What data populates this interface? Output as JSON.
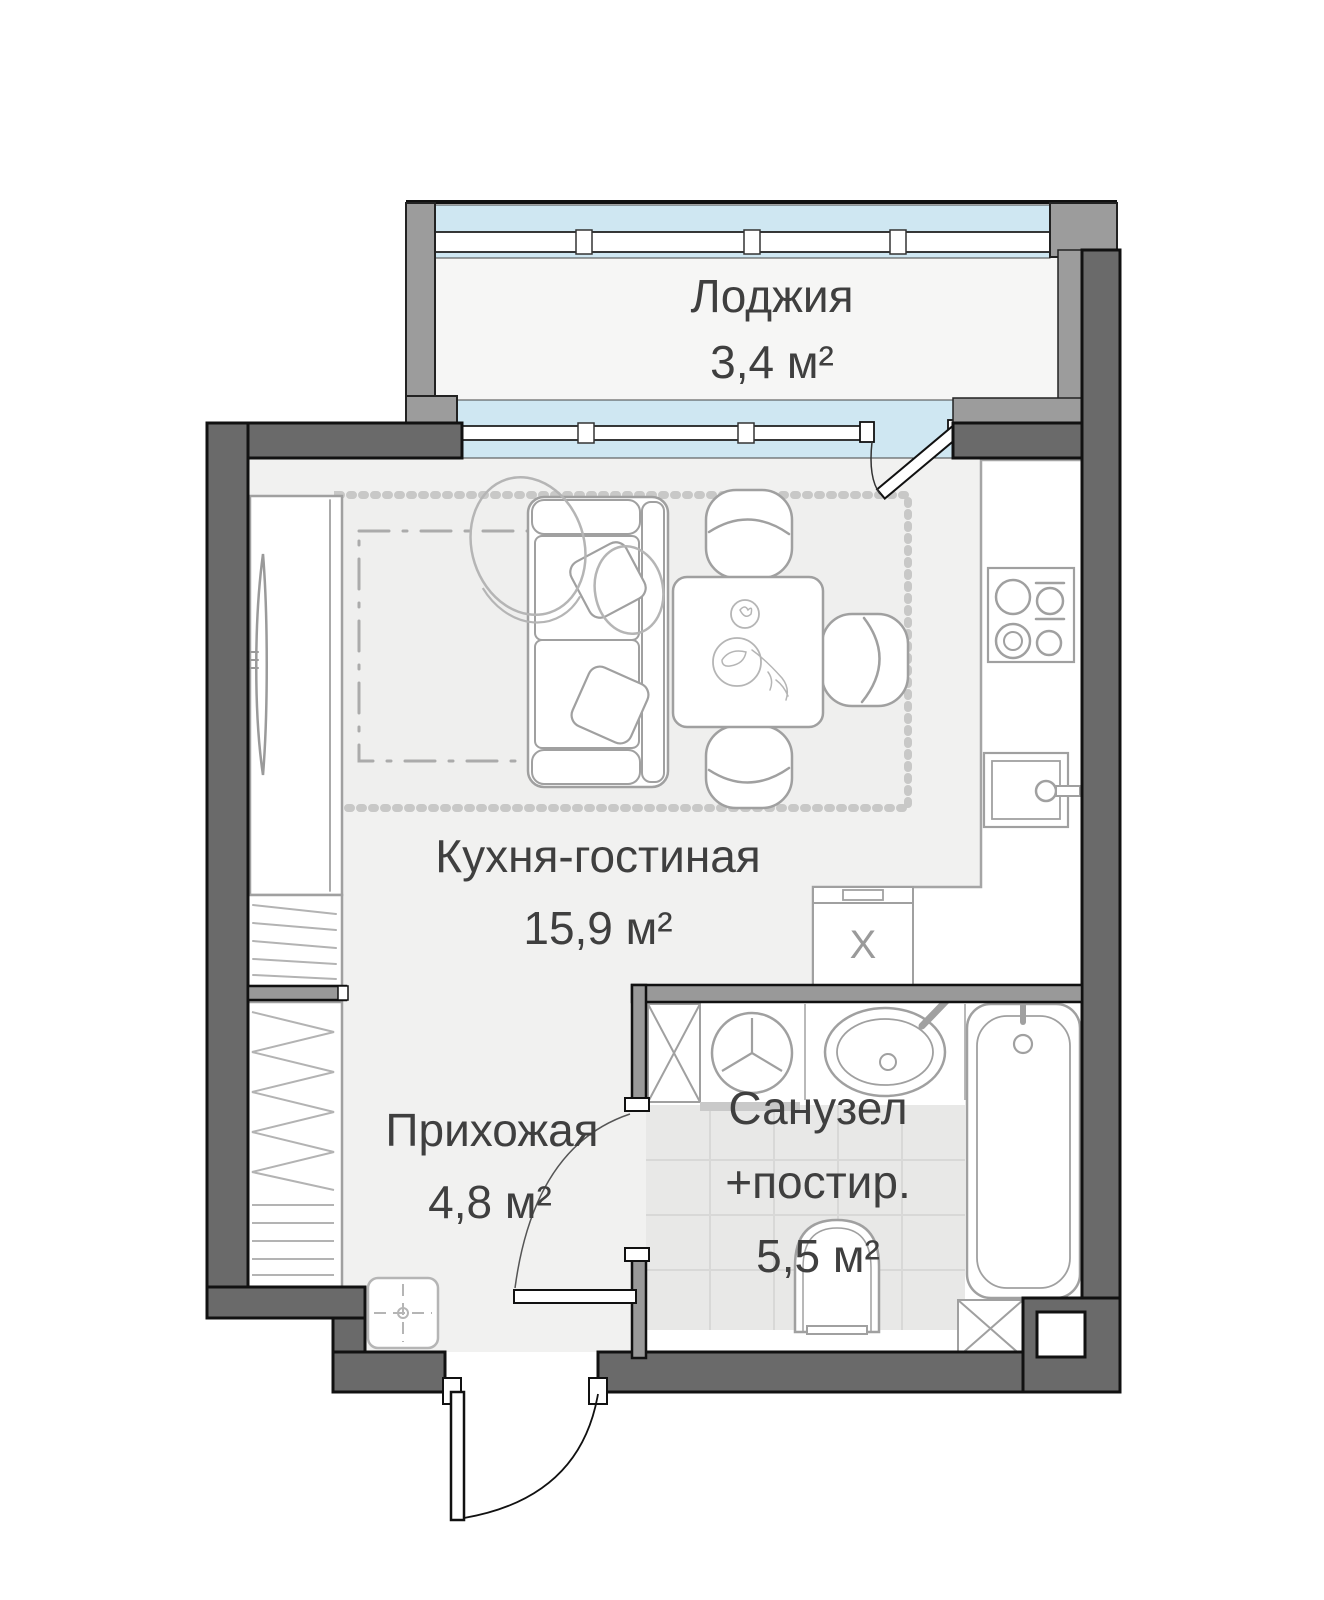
{
  "plan": {
    "type": "apartment-floor-plan",
    "language": "ru",
    "rooms": {
      "loggia": {
        "name": "Лоджия",
        "area": "3,4 м²"
      },
      "kitchen_living": {
        "name": "Кухня-гостиная",
        "area": "15,9 м²"
      },
      "hallway": {
        "name": "Прихожая",
        "area": "4,8 м²"
      },
      "bathroom": {
        "name": "Санузел",
        "name_line2": "+постир.",
        "area": "5,5 м²"
      }
    },
    "appliance_label": "X",
    "fixtures": [
      "sofa",
      "pillows",
      "dining-table",
      "chair",
      "tv",
      "tv-console",
      "wardrobe-living",
      "wardrobe-hallway",
      "rug",
      "bed-outline",
      "kitchen-counter",
      "hob",
      "kitchen-sink",
      "appliance-x",
      "washing-machine",
      "washbasin",
      "bathtub",
      "toilet",
      "duct-shaft",
      "doormat",
      "loggia-ottomans",
      "balcony-door",
      "entry-door",
      "bathroom-door",
      "window-loggia",
      "window-living"
    ],
    "colors": {
      "wall_dark": "#6a6a6a",
      "wall_light": "#9c9c9c",
      "interior_wall": "#999999",
      "glazing": "#cfe7f2",
      "floor": "#f1f1f0",
      "loggia_floor": "#f6f6f5",
      "tile": "#e8e8e7",
      "tile_grid": "#d8d8d7",
      "fixture_stroke": "#a0a0a0",
      "outline": "#111111",
      "text": "#3f3f3f"
    }
  }
}
